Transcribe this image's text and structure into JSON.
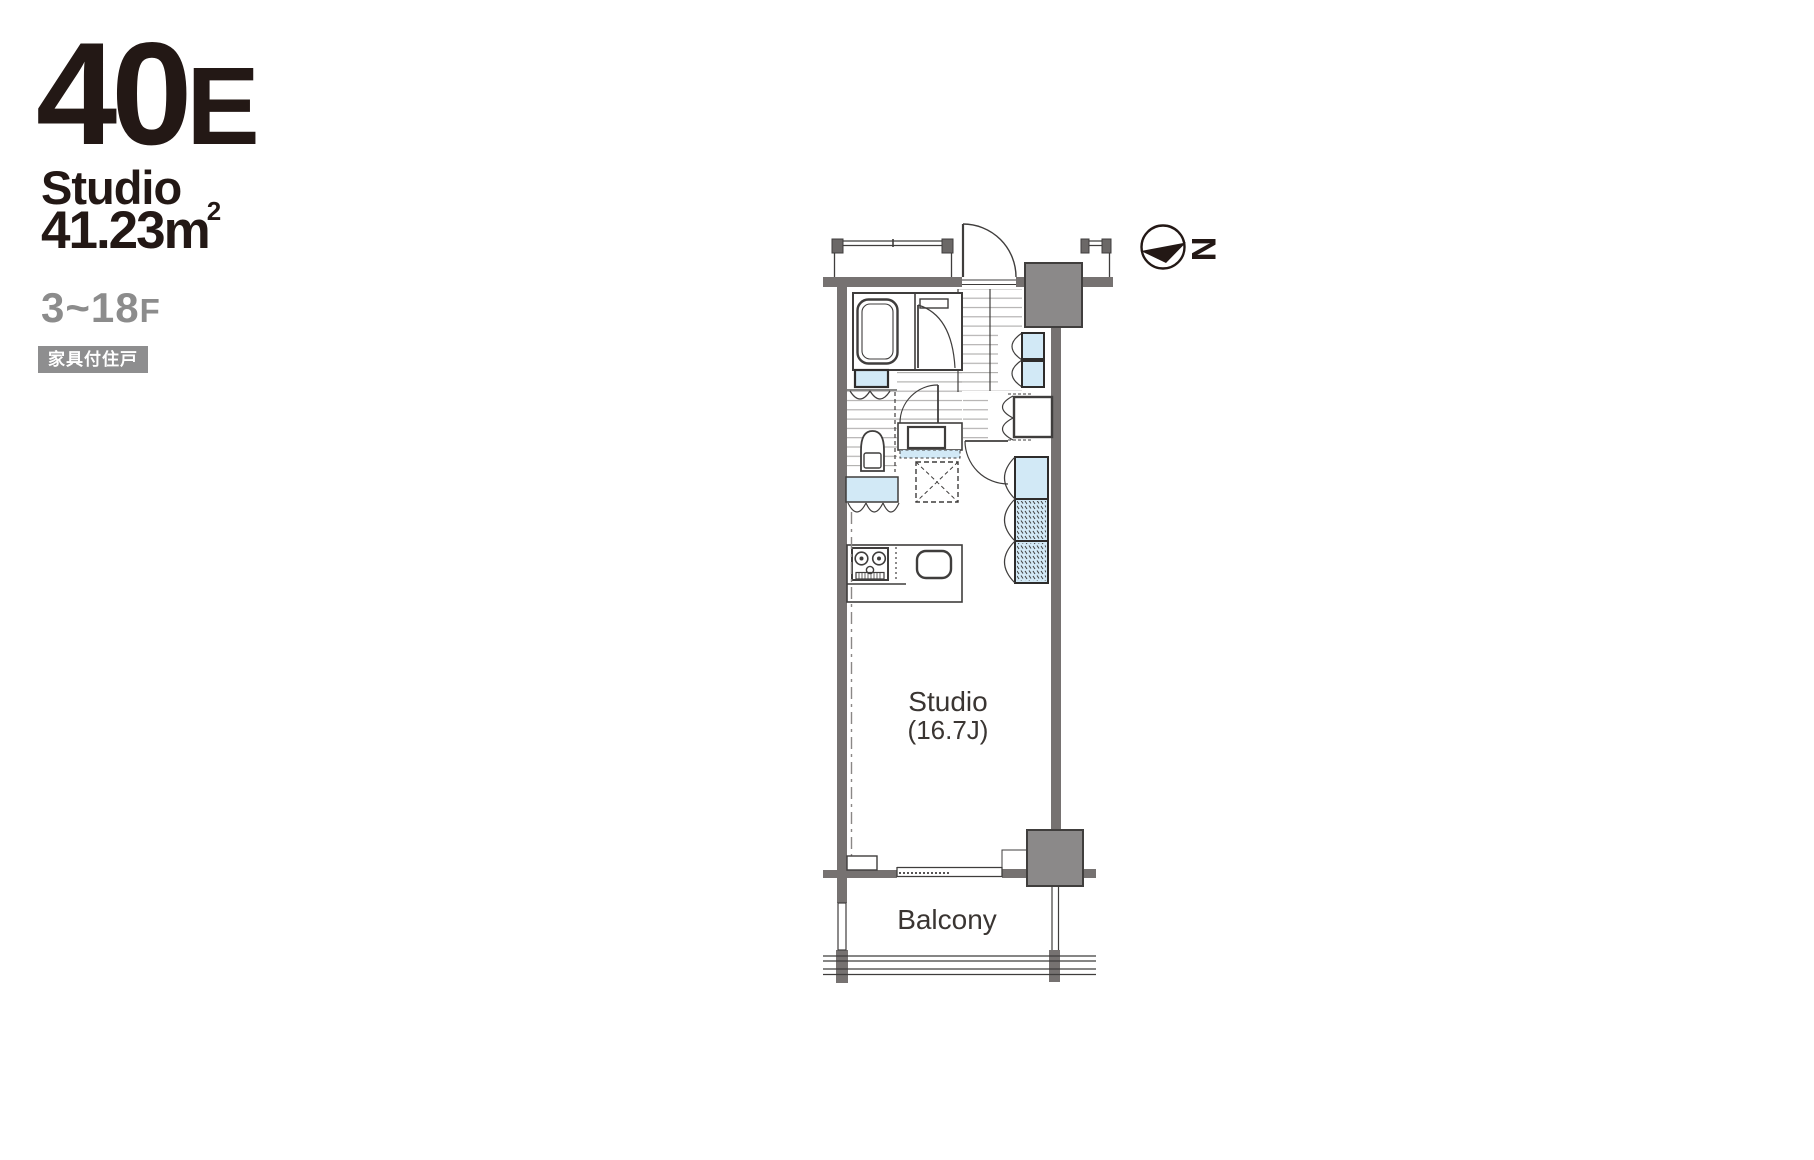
{
  "unit": {
    "id_main": "40",
    "id_suffix": "E",
    "type": "Studio",
    "area_label": "41.23m",
    "area_sup": "2",
    "floors_range": "3~18",
    "floors_suffix": "F",
    "badge": "家具付住戸"
  },
  "plan": {
    "room_label": "Studio",
    "room_size": "(16.7J)",
    "balcony_label": "Balcony",
    "north_letter": "N"
  },
  "colors": {
    "line": "#3f3d3c",
    "wall_gray": "#767271",
    "column_gray": "#8b8989",
    "fixture_blue": "#d2e9f6",
    "text_dark": "#231815",
    "text_gray": "#8c8c8c",
    "badge_bg": "#8e8e8f"
  }
}
